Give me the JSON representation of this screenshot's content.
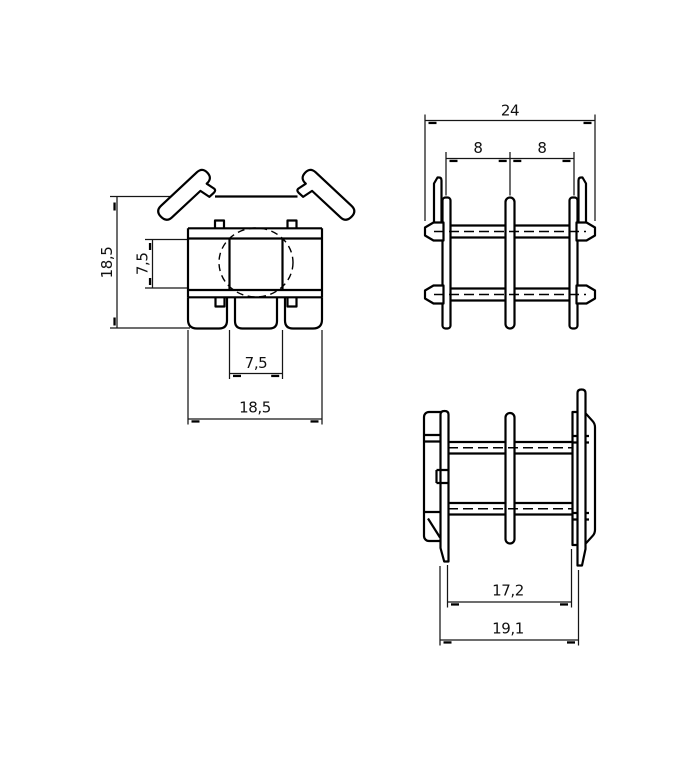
{
  "front_view": {
    "dim_height": "18,5",
    "dim_inner_height": "7,5",
    "dim_slot_width": "7,5",
    "dim_width": "18,5"
  },
  "top_view": {
    "dim_overall": "24",
    "dim_pitch_left": "8",
    "dim_pitch_right": "8"
  },
  "bottom_view": {
    "dim_inner": "17,2",
    "dim_overall": "19,1"
  },
  "style": {
    "line_color": "#000000",
    "background": "#ffffff"
  }
}
